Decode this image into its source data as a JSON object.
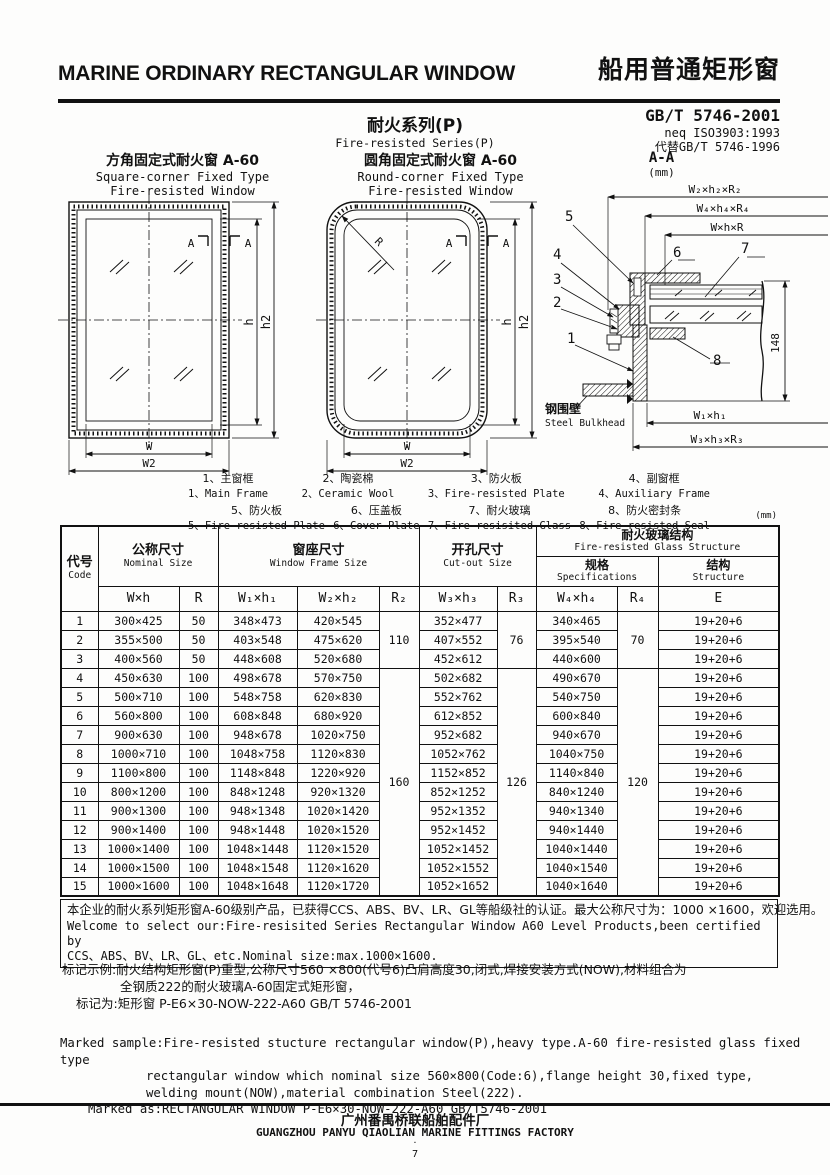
{
  "header": {
    "title_en": "MARINE ORDINARY RECTANGULAR WINDOW",
    "title_cn": "船用普通矩形窗",
    "standard": "GB/T 5746-2001",
    "standard_neq": "neq ISO3903:1993",
    "standard_replace": "代替GB/T 5746-1996",
    "series_cn": "耐火系列(P)",
    "series_en": "Fire-resisted Series(P)"
  },
  "drawings": {
    "square": {
      "title_cn": "方角固定式耐火窗  A-60",
      "title_en1": "Square-corner Fixed Type",
      "title_en2": "Fire-resisted Window",
      "dim_w": "W",
      "dim_w2": "W2",
      "dim_h": "h",
      "dim_h2": "h2",
      "section_mark": "A"
    },
    "round": {
      "title_cn": "圆角固定式耐火窗  A-60",
      "title_en1": "Round-corner Fixed Type",
      "title_en2": "Fire-resisted Window",
      "dim_w": "W",
      "dim_w2": "W2",
      "dim_h": "h",
      "dim_h2": "h2",
      "dim_r": "R",
      "section_mark": "A"
    },
    "section": {
      "title": "A-A",
      "unit": "(mm)",
      "dims_top": [
        "W₂×h₂×R₂",
        "W₄×h₄×R₄",
        "W×h×R"
      ],
      "dim_height": "148",
      "dims_bottom": [
        "W₁×h₁",
        "W₃×h₃×R₃"
      ],
      "bulkhead_cn": "钢围壁",
      "bulkhead_en": "Steel Bulkhead",
      "callouts": [
        "1",
        "2",
        "3",
        "4",
        "5",
        "6",
        "7",
        "8"
      ]
    }
  },
  "legend": {
    "row1": [
      {
        "cn": "1、主窗框",
        "en": "1、Main Frame"
      },
      {
        "cn": "2、陶瓷棉",
        "en": "2、Ceramic Wool"
      },
      {
        "cn": "3、防火板",
        "en": "3、Fire-resisted Plate"
      },
      {
        "cn": "4、副窗框",
        "en": "4、Auxiliary Frame"
      }
    ],
    "row2": [
      {
        "cn": "5、防火板",
        "en": "5、Fire-resisted Plate"
      },
      {
        "cn": "6、压盖板",
        "en": "6、Cover Plate"
      },
      {
        "cn": "7、耐火玻璃",
        "en": "7、Fire-resisited Glass"
      },
      {
        "cn": "8、防火密封条",
        "en": "8、Fire-resisted Seal"
      }
    ]
  },
  "table": {
    "unit_note": "(mm)",
    "headers": {
      "code_cn": "代号",
      "code_en": "Code",
      "nominal_cn": "公称尺寸",
      "nominal_en": "Nominal Size",
      "frame_cn": "窗座尺寸",
      "frame_en": "Window Frame Size",
      "cutout_cn": "开孔尺寸",
      "cutout_en": "Cut-out Size",
      "glass_cn": "耐火玻璃结构",
      "glass_en": "Fire-resisted Glass Structure",
      "spec_cn": "规格",
      "spec_en": "Specifications",
      "structure_cn": "结构",
      "structure_en": "Structure",
      "dims": [
        "W×h",
        "R",
        "W₁×h₁",
        "W₂×h₂",
        "R₂",
        "W₃×h₃",
        "R₃",
        "W₄×h₄",
        "R₄",
        "E"
      ]
    },
    "merged": {
      "g1": {
        "r2": "110",
        "r3": "76",
        "r4": "70"
      },
      "g2": {
        "r2": "160",
        "r3": "126",
        "r4": "120"
      }
    },
    "rows": [
      [
        "1",
        "300×425",
        "50",
        "348×473",
        "420×545",
        "352×477",
        "340×465",
        "19+20+6"
      ],
      [
        "2",
        "355×500",
        "50",
        "403×548",
        "475×620",
        "407×552",
        "395×540",
        "19+20+6"
      ],
      [
        "3",
        "400×560",
        "50",
        "448×608",
        "520×680",
        "452×612",
        "440×600",
        "19+20+6"
      ],
      [
        "4",
        "450×630",
        "100",
        "498×678",
        "570×750",
        "502×682",
        "490×670",
        "19+20+6"
      ],
      [
        "5",
        "500×710",
        "100",
        "548×758",
        "620×830",
        "552×762",
        "540×750",
        "19+20+6"
      ],
      [
        "6",
        "560×800",
        "100",
        "608×848",
        "680×920",
        "612×852",
        "600×840",
        "19+20+6"
      ],
      [
        "7",
        "900×630",
        "100",
        "948×678",
        "1020×750",
        "952×682",
        "940×670",
        "19+20+6"
      ],
      [
        "8",
        "1000×710",
        "100",
        "1048×758",
        "1120×830",
        "1052×762",
        "1040×750",
        "19+20+6"
      ],
      [
        "9",
        "1100×800",
        "100",
        "1148×848",
        "1220×920",
        "1152×852",
        "1140×840",
        "19+20+6"
      ],
      [
        "10",
        "800×1200",
        "100",
        "848×1248",
        "920×1320",
        "852×1252",
        "840×1240",
        "19+20+6"
      ],
      [
        "11",
        "900×1300",
        "100",
        "948×1348",
        "1020×1420",
        "952×1352",
        "940×1340",
        "19+20+6"
      ],
      [
        "12",
        "900×1400",
        "100",
        "948×1448",
        "1020×1520",
        "952×1452",
        "940×1440",
        "19+20+6"
      ],
      [
        "13",
        "1000×1400",
        "100",
        "1048×1448",
        "1120×1520",
        "1052×1452",
        "1040×1440",
        "19+20+6"
      ],
      [
        "14",
        "1000×1500",
        "100",
        "1048×1548",
        "1120×1620",
        "1052×1552",
        "1040×1540",
        "19+20+6"
      ],
      [
        "15",
        "1000×1600",
        "100",
        "1048×1648",
        "1120×1720",
        "1052×1652",
        "1040×1640",
        "19+20+6"
      ]
    ]
  },
  "notes": {
    "box": [
      "本企业的耐火系列矩形窗A-60级别产品，已获得CCS、ABS、BV、LR、GL等船级社的认证。最大公称尺寸为：1000 ×1600，欢迎选用。",
      "Welcome to select our:Fire-resisited Series Rectangular Window A60 Level Products,been certified by",
      "CCS、ABS、BV、LR、GL、etc.Nominal size:max.1000×1600."
    ],
    "mark_cn": [
      "标记示例:耐火结构矩形窗(P)重型,公称尺寸560 ×800(代号6)凸肩高度30,闭式,焊接安装方式(NOW),材料组合为",
      "全钢质222的耐火玻璃A-60固定式矩形窗，",
      "标记为:矩形窗  P-E6×30-NOW-222-A60  GB/T 5746-2001"
    ],
    "mark_en": [
      "Marked sample:Fire-resisted stucture rectangular window(P),heavy type.A-60 fire-resisted glass fixed type",
      "rectangular window which nominal size 560×800(Code:6),flange height 30,fixed type,",
      "welding mount(NOW),material combination Steel(222).",
      "Marked as:RECTANGULAR WINDOW  P-E6×30-NOW-222-A60  GB/T5746-2001"
    ]
  },
  "footer": {
    "company_cn": "广州番禺桥联船舶配件厂",
    "company_en": "GUANGZHOU PANYU QIAOLIAN MARINE FITTINGS FACTORY",
    "dot": "·",
    "page": "7"
  }
}
